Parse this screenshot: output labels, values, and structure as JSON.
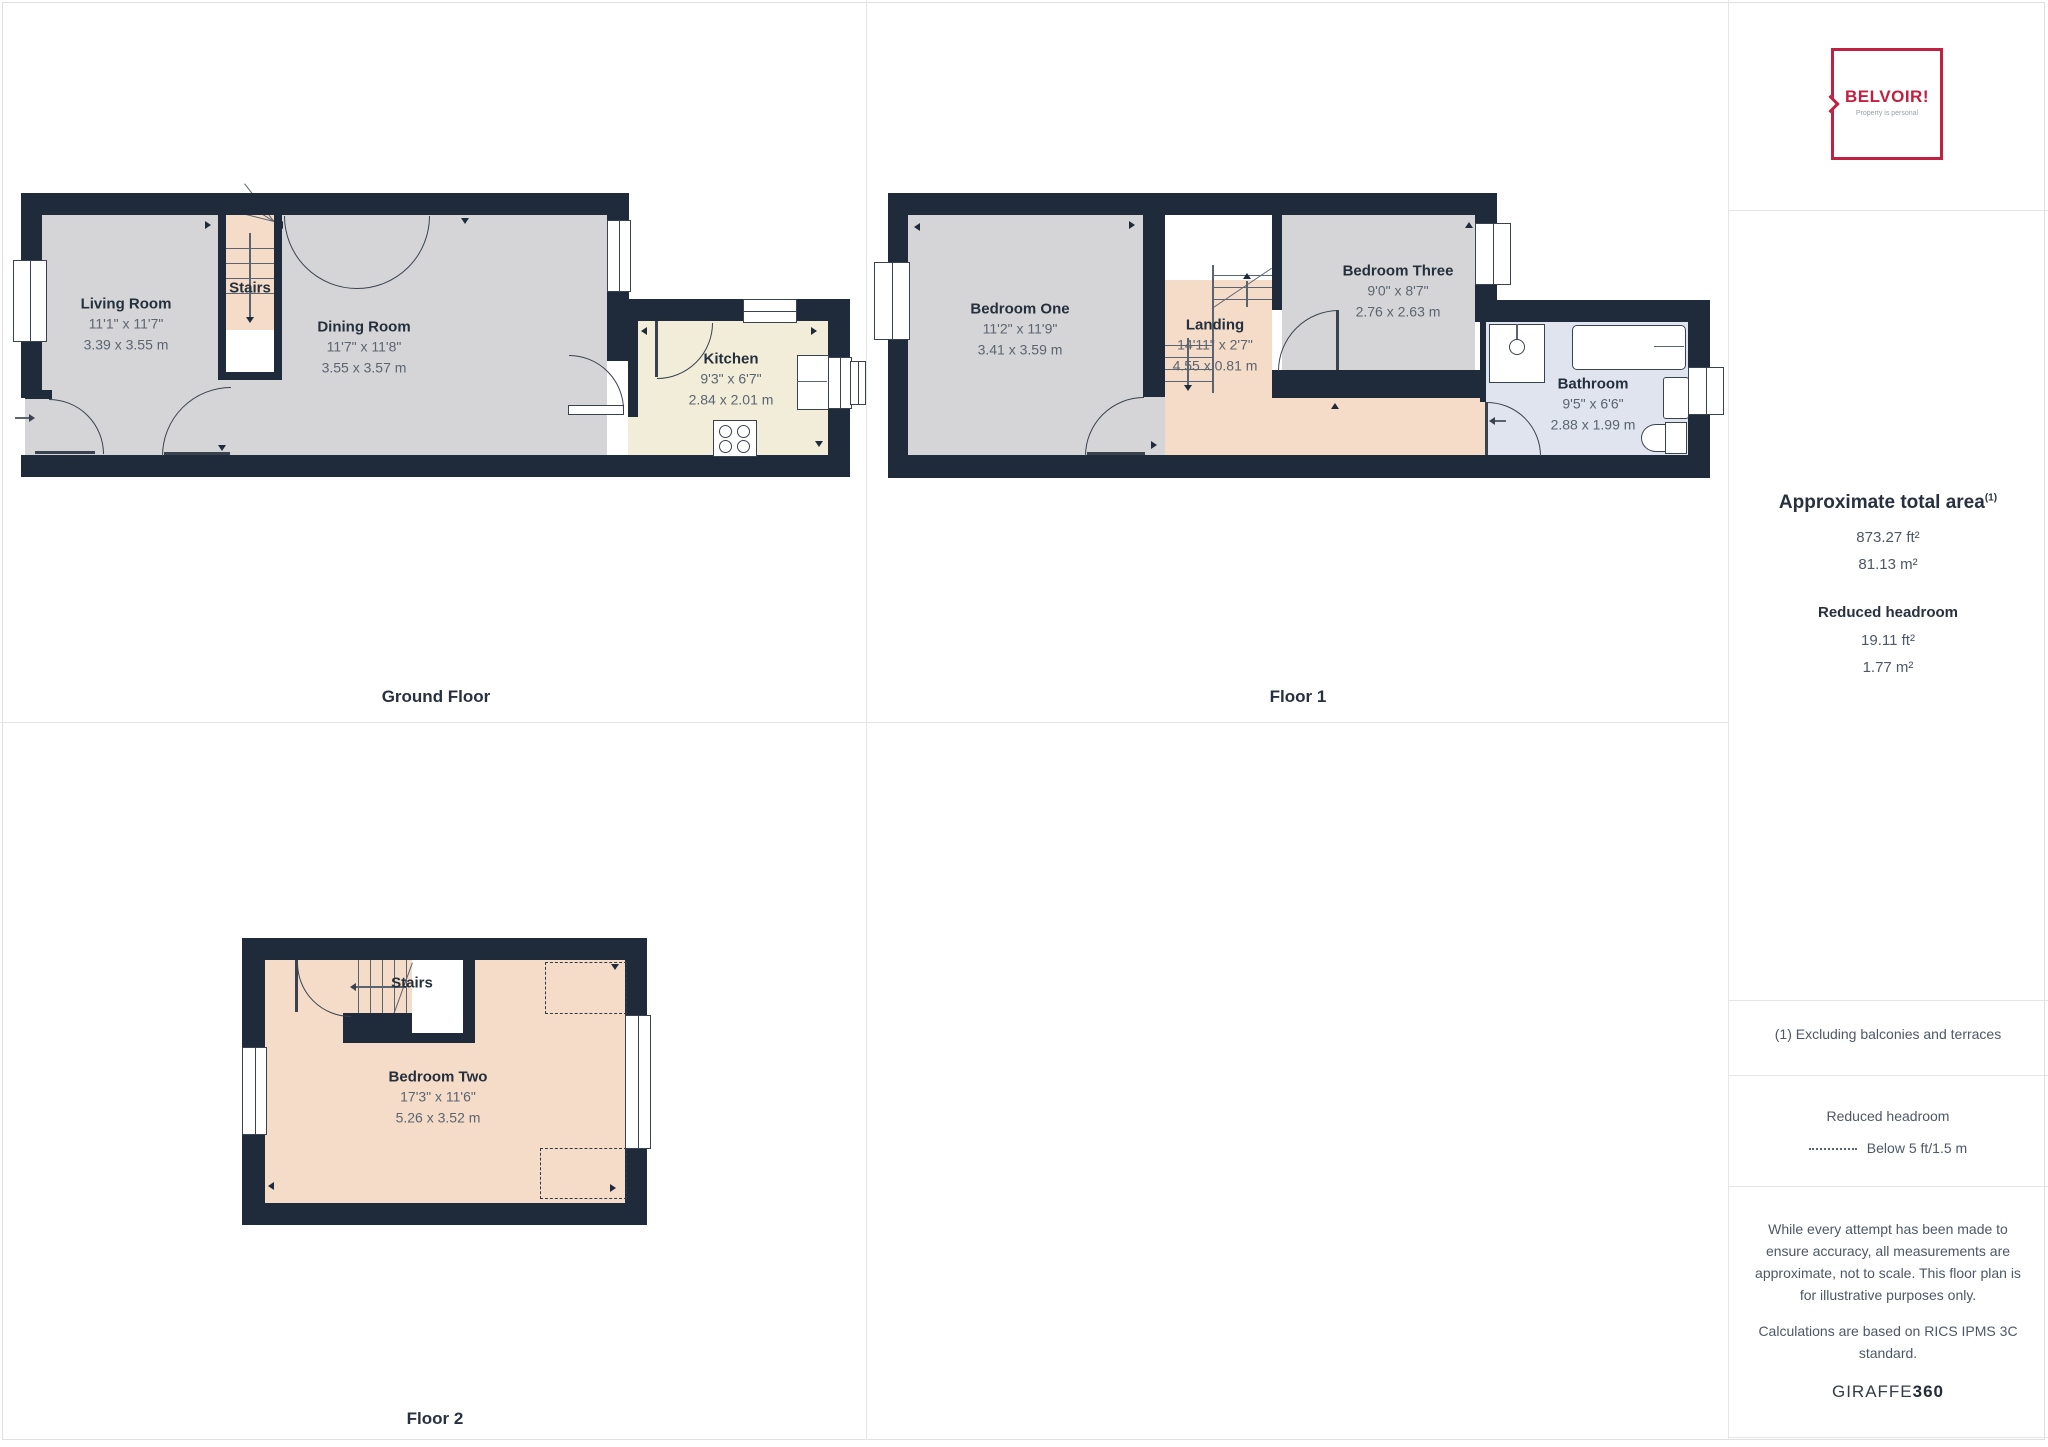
{
  "floors": {
    "ground": {
      "label": "Ground Floor",
      "rooms": {
        "living": {
          "name": "Living Room",
          "imperial": "11'1\" x 11'7\"",
          "metric": "3.39 x 3.55 m"
        },
        "stairs": {
          "name": "Stairs"
        },
        "dining": {
          "name": "Dining Room",
          "imperial": "11'7\" x 11'8\"",
          "metric": "3.55 x 3.57 m"
        },
        "kitchen": {
          "name": "Kitchen",
          "imperial": "9'3\" x 6'7\"",
          "metric": "2.84 x 2.01 m"
        }
      }
    },
    "first": {
      "label": "Floor 1",
      "rooms": {
        "bedroom_one": {
          "name": "Bedroom One",
          "imperial": "11'2\" x 11'9\"",
          "metric": "3.41 x 3.59 m"
        },
        "landing": {
          "name": "Landing",
          "imperial": "14'11\" x 2'7\"",
          "metric": "4.55 x 0.81 m"
        },
        "bedroom_three": {
          "name": "Bedroom Three",
          "imperial": "9'0\" x 8'7\"",
          "metric": "2.76 x 2.63 m"
        },
        "bathroom": {
          "name": "Bathroom",
          "imperial": "9'5\" x 6'6\"",
          "metric": "2.88 x 1.99 m"
        }
      }
    },
    "second": {
      "label": "Floor 2",
      "rooms": {
        "stairs": {
          "name": "Stairs"
        },
        "bedroom_two": {
          "name": "Bedroom Two",
          "imperial": "17'3\" x 11'6\"",
          "metric": "5.26 x 3.52 m"
        }
      }
    }
  },
  "sidebar": {
    "logo": {
      "brand": "BELVOIR!",
      "tagline": "Property is personal"
    },
    "area_title": "Approximate total area",
    "area_superscript": "(1)",
    "area_ft": "873.27 ft²",
    "area_m": "81.13 m²",
    "reduced_title": "Reduced headroom",
    "reduced_ft": "19.11 ft²",
    "reduced_m": "1.77 m²",
    "footnote": "(1) Excluding balconies and terraces",
    "legend_title": "Reduced headroom",
    "legend_item": "Below 5 ft/1.5 m",
    "disclaimer_1": "While every attempt has been made to ensure accuracy, all measurements are approximate, not to scale. This floor plan is for illustrative purposes only.",
    "disclaimer_2": "Calculations are based on RICS IPMS 3C standard.",
    "brand_name": "GIRAFFE",
    "brand_suffix": "360"
  },
  "colors": {
    "accent": "#c22040",
    "wall": "#1f2b3b",
    "room_gray": "#d5d5d7",
    "room_peach": "#f5dcc9",
    "room_cream": "#f2edd9",
    "room_blue": "#dfe4ef"
  }
}
